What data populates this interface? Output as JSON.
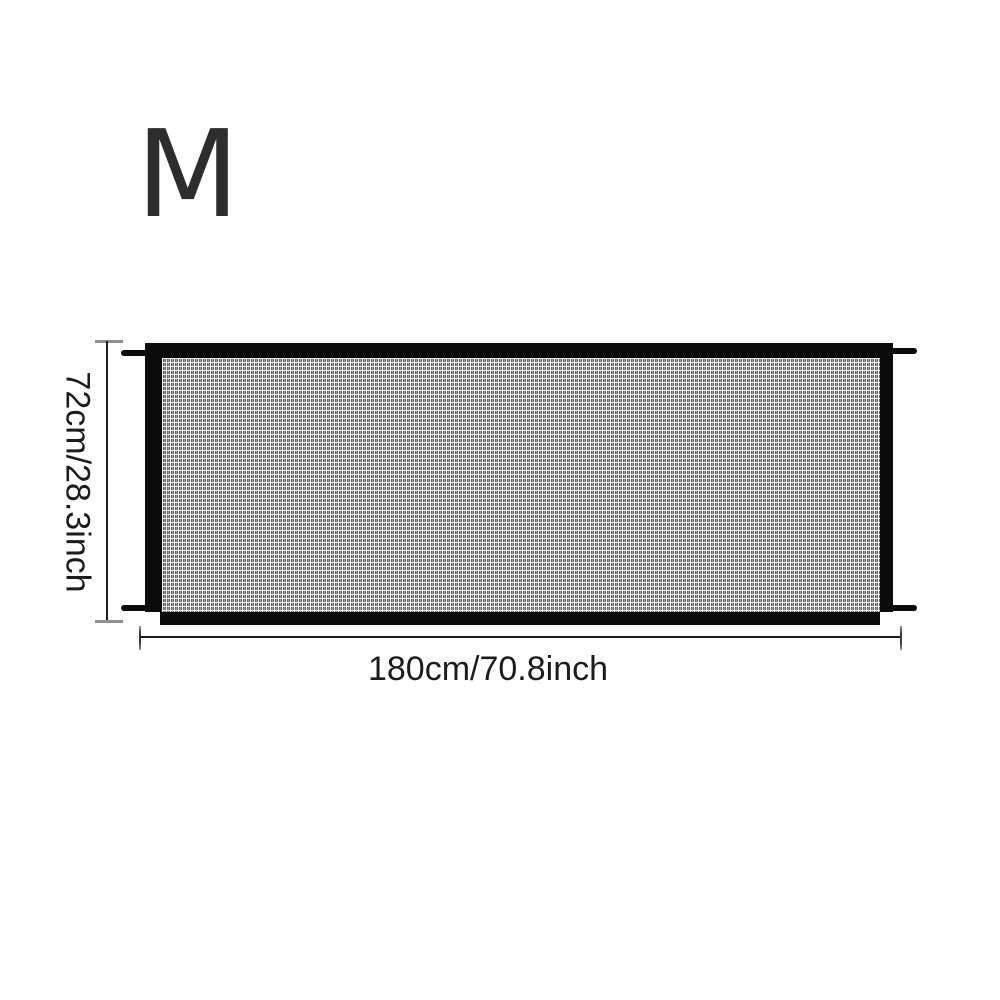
{
  "size_label": "M",
  "dimensions": {
    "height_label": "72cm/28.3inch",
    "width_label": "180cm/70.8inch"
  },
  "icons": {
    "gate_mesh": "mesh-texture",
    "mounting_straps": "mounting-strap-tabs"
  },
  "colors": {
    "background": "#ffffff",
    "gate_frame": "#0b0b0b",
    "mesh_base": "#646464",
    "mesh_grid": "#f2f2f2",
    "dimension_line": "#1c1c1c",
    "dimension_cap": "#8f8f8f",
    "text": "#1c1c1c",
    "size_label_text": "#2d2d2d"
  }
}
